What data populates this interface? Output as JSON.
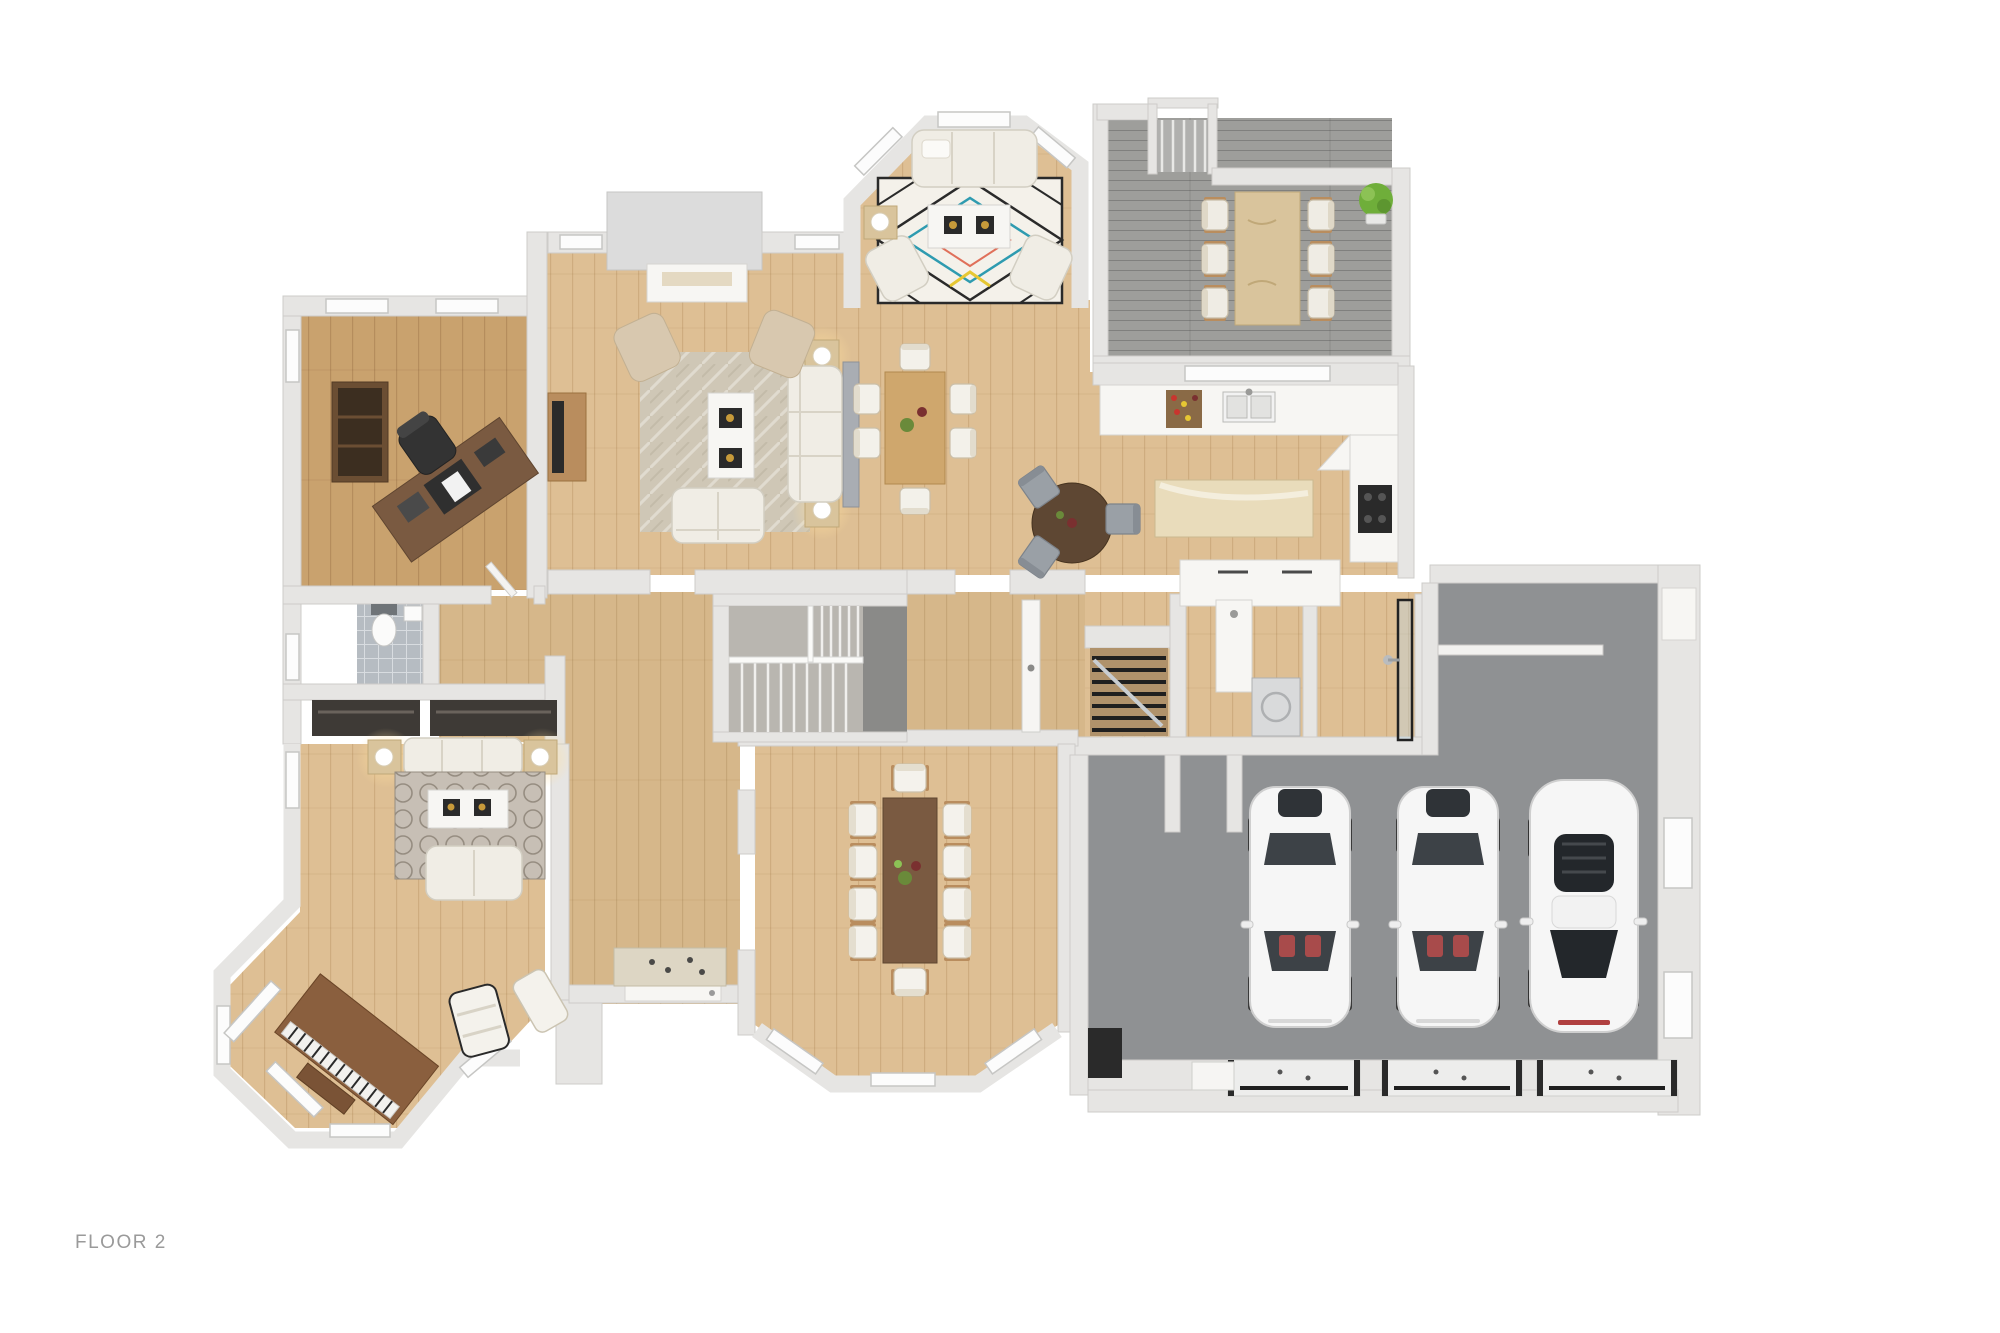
{
  "page": {
    "background": "#ffffff"
  },
  "floor_plan": {
    "type": "3d-rendered-top-view-floor-plan",
    "floor_label": "FLOOR 2",
    "rooms": [
      {
        "name": "office",
        "floor": "dark-wood",
        "furniture": [
          "diagonal-desk",
          "desk-chair",
          "bookshelf",
          "desk-accessories"
        ]
      },
      {
        "name": "living-room",
        "floor": "light-wood",
        "furniture": [
          "sofa",
          "loveseat",
          "armchair",
          "armchair",
          "coffee-table-with-trays",
          "lamp-side-table",
          "lamp-side-table",
          "console",
          "fireplace-with-chimney",
          "wall-tv-console",
          "area-rug"
        ]
      },
      {
        "name": "family-bay-nook",
        "floor": "light-wood",
        "furniture": [
          "sofa",
          "armchair",
          "armchair",
          "white-coffee-table",
          "candle-side-table",
          "geometric-pattern-rug"
        ]
      },
      {
        "name": "casual-dining-area",
        "floor": "light-wood",
        "furniture": [
          "wood-table",
          "6-white-chairs",
          "centerpiece"
        ]
      },
      {
        "name": "kitchen",
        "floor": "light-wood",
        "furniture": [
          "counter-run",
          "double-sink",
          "window-over-sink",
          "wine-rack",
          "cooktop",
          "island",
          "round-breakfast-table",
          "3-gray-chairs",
          "lower-cabinets"
        ]
      },
      {
        "name": "deck",
        "floor": "gray-wood-planks",
        "furniture": [
          "outdoor-dining-table",
          "6-chairs",
          "potted-plant",
          "exterior-stairs"
        ]
      },
      {
        "name": "hallway",
        "floor": "light-wood",
        "furniture": [
          "staircase-up",
          "stair-void",
          "open-door"
        ]
      },
      {
        "name": "mudroom-utility",
        "floor": "light-wood",
        "furniture": [
          "white-cabinets",
          "basement-stairs",
          "utility-sink",
          "washer",
          "shower-room-with-glass-door"
        ]
      },
      {
        "name": "powder-room",
        "floor": "gray-tile",
        "furniture": [
          "toilet",
          "small-sink",
          "window"
        ]
      },
      {
        "name": "hall-closets",
        "floor": "wood",
        "furniture": [
          "closet",
          "closet"
        ]
      },
      {
        "name": "entry-foyer",
        "floor": "light-wood",
        "furniture": [
          "doormat",
          "front-door"
        ]
      },
      {
        "name": "music-room",
        "floor": "light-wood",
        "furniture": [
          "upright-piano-diagonal",
          "sofa",
          "loveseat",
          "coffee-table-with-trays",
          "lamp-side-table",
          "lamp-side-table",
          "trellis-rug",
          "lounge-chair",
          "lounge-chair",
          "bay-windows"
        ]
      },
      {
        "name": "formal-dining-room",
        "floor": "light-wood",
        "furniture": [
          "long-dark-table",
          "10-chairs",
          "centerpiece",
          "bay-windows"
        ]
      },
      {
        "name": "garage",
        "floor": "gray-concrete",
        "furniture": [
          "white-sedan",
          "white-sedan",
          "white-sports-car",
          "garage-door",
          "garage-door",
          "garage-door",
          "workbench",
          "wall-shelf",
          "side-door",
          "windows"
        ]
      }
    ],
    "car_count": 3,
    "garage_door_count": 3
  },
  "colors": {
    "wall": "#e6e5e3",
    "wallEdge": "#cdccc9",
    "woodMain": "#debf94",
    "woodOffice": "#c9a26e",
    "woodMid": "#d6b78a",
    "deck": "#9e9e9b",
    "garage": "#8f9193",
    "tile": "#b6bcc2",
    "rugLiving": "#cfc7b6",
    "rugTrellis": "#c7bfb5",
    "rugGeo": "#f4f1ea",
    "accentTeal": "#2e9bb0",
    "accentRed": "#e0705a",
    "accentYellow": "#e6c733",
    "sofa": "#f0ede5",
    "chairBeige": "#d8c8af",
    "darkTable": "#7a5a41",
    "lightTable": "#d9c49c",
    "midWood": "#b98d5e",
    "piano": "#8a5f3e",
    "black": "#2a2a2a",
    "carWhite": "#f6f6f6",
    "glass": "#3d4247",
    "island": "#e9dcbb",
    "glow": "#ffdf9e",
    "label": "#9a9a9a"
  }
}
